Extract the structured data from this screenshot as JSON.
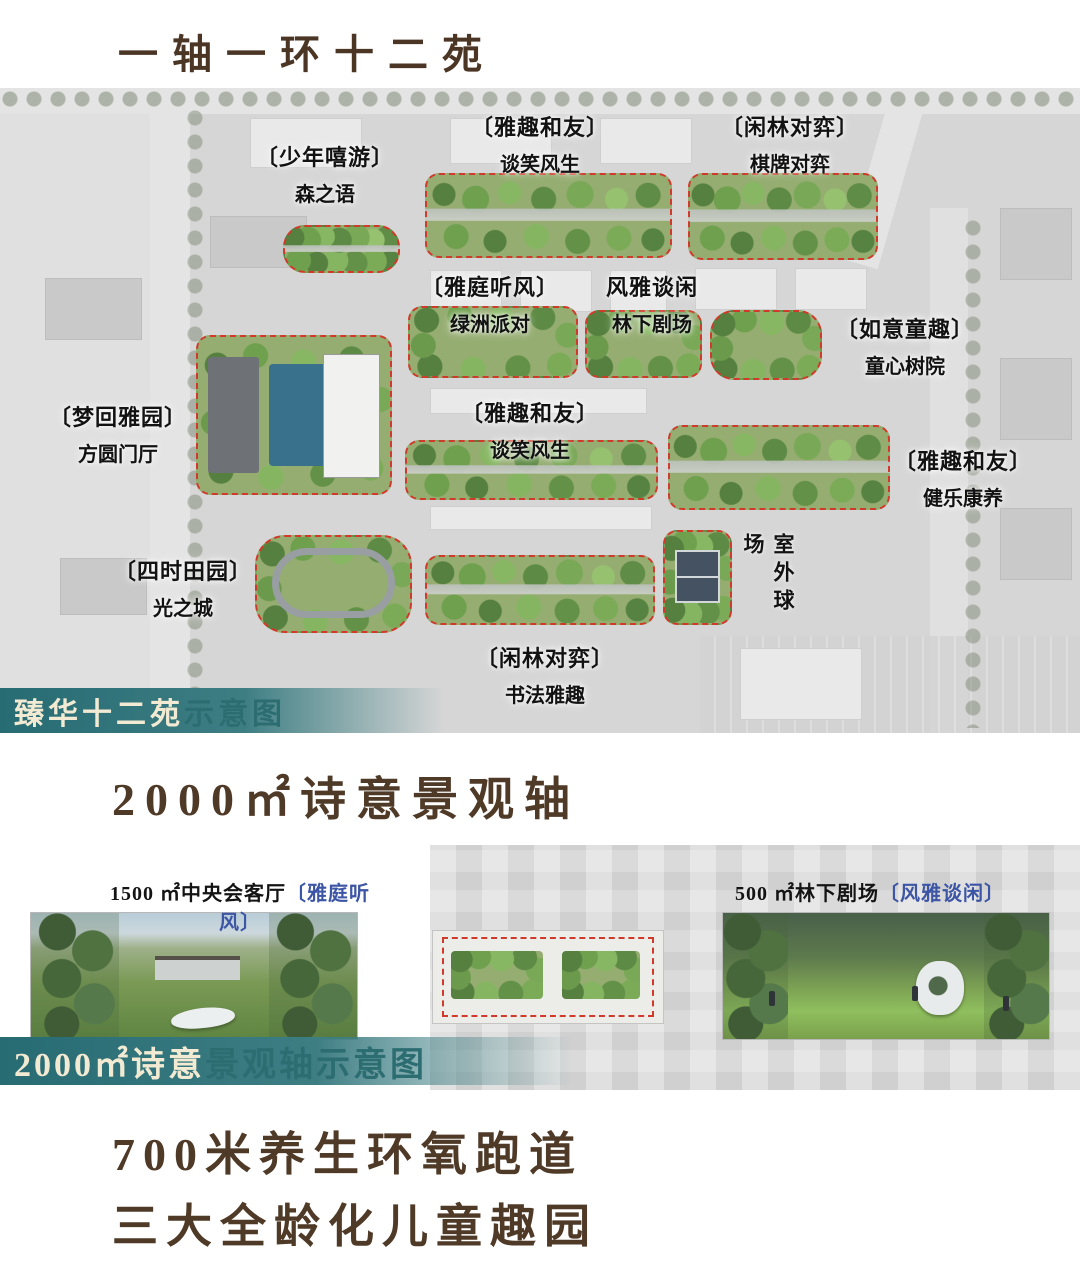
{
  "title": "一轴一环十二苑",
  "map": {
    "caption_part1": "臻华十二苑",
    "caption_part2": "示意图",
    "zones": [
      {
        "bracket": "〔少年嘻游〕",
        "sub": "森之语"
      },
      {
        "bracket": "〔雅趣和友〕",
        "sub": "谈笑风生"
      },
      {
        "bracket": "〔闲林对弈〕",
        "sub": "棋牌对弈"
      },
      {
        "bracket": "〔雅庭听风〕",
        "sub": "绿洲派对"
      },
      {
        "bracket": "风雅谈闲",
        "sub": "林下剧场"
      },
      {
        "bracket": "〔如意童趣〕",
        "sub": "童心树院"
      },
      {
        "bracket": "〔梦回雅园〕",
        "sub": "方圆门厅"
      },
      {
        "bracket": "〔雅趣和友〕",
        "sub": "谈笑风生"
      },
      {
        "bracket": "〔雅趣和友〕",
        "sub": "健乐康养"
      },
      {
        "bracket": "〔四时田园〕",
        "sub": "光之城"
      },
      {
        "bracket": "〔闲林对弈〕",
        "sub": "书法雅趣"
      },
      {
        "vertical": "室外球场"
      }
    ]
  },
  "landscape_axis": {
    "heading": "2000㎡诗意景观轴",
    "photo_left_label_black": "1500 ㎡中央会客厅",
    "photo_left_label_blue": "〔雅庭听风〕",
    "photo_right_label_black": "500 ㎡林下剧场",
    "photo_right_label_blue": "〔风雅谈闲〕",
    "caption_part1": "2000㎡诗意",
    "caption_part2": "景观轴示意图"
  },
  "footer": {
    "line1": "700米养生环氧跑道",
    "line2": "三大全龄化儿童趣园"
  },
  "colors": {
    "heading_brown": "#4f3a27",
    "caption_teal": "#2c6d72",
    "caption_cream": "#f2ead2",
    "label_blue": "#3c55a4",
    "zone_outline_red": "#cf3a2a",
    "pond_blue": "#39708c"
  }
}
